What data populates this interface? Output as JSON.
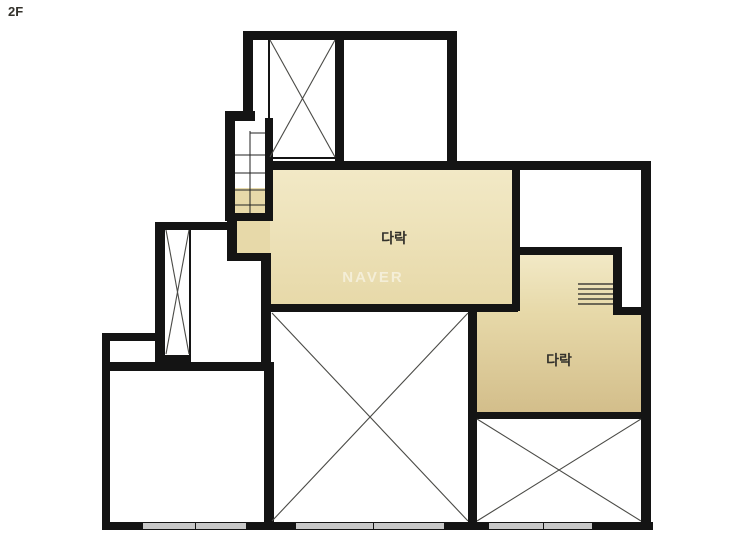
{
  "floor_label": "2F",
  "watermark": "NAVER",
  "labels": {
    "attic_main": "다락",
    "attic_right": "다락"
  },
  "colors": {
    "wall": "#141414",
    "tan_light": "#f2e9c6",
    "tan_mid": "#e7d9a9",
    "tan_dark": "#d3be8b",
    "window_fill": "#c9c9c9",
    "diagonal": "#4a4a46",
    "tread": "#222222",
    "label_text": "#33312b",
    "watermark_text": "rgba(255,255,255,0.5)"
  }
}
